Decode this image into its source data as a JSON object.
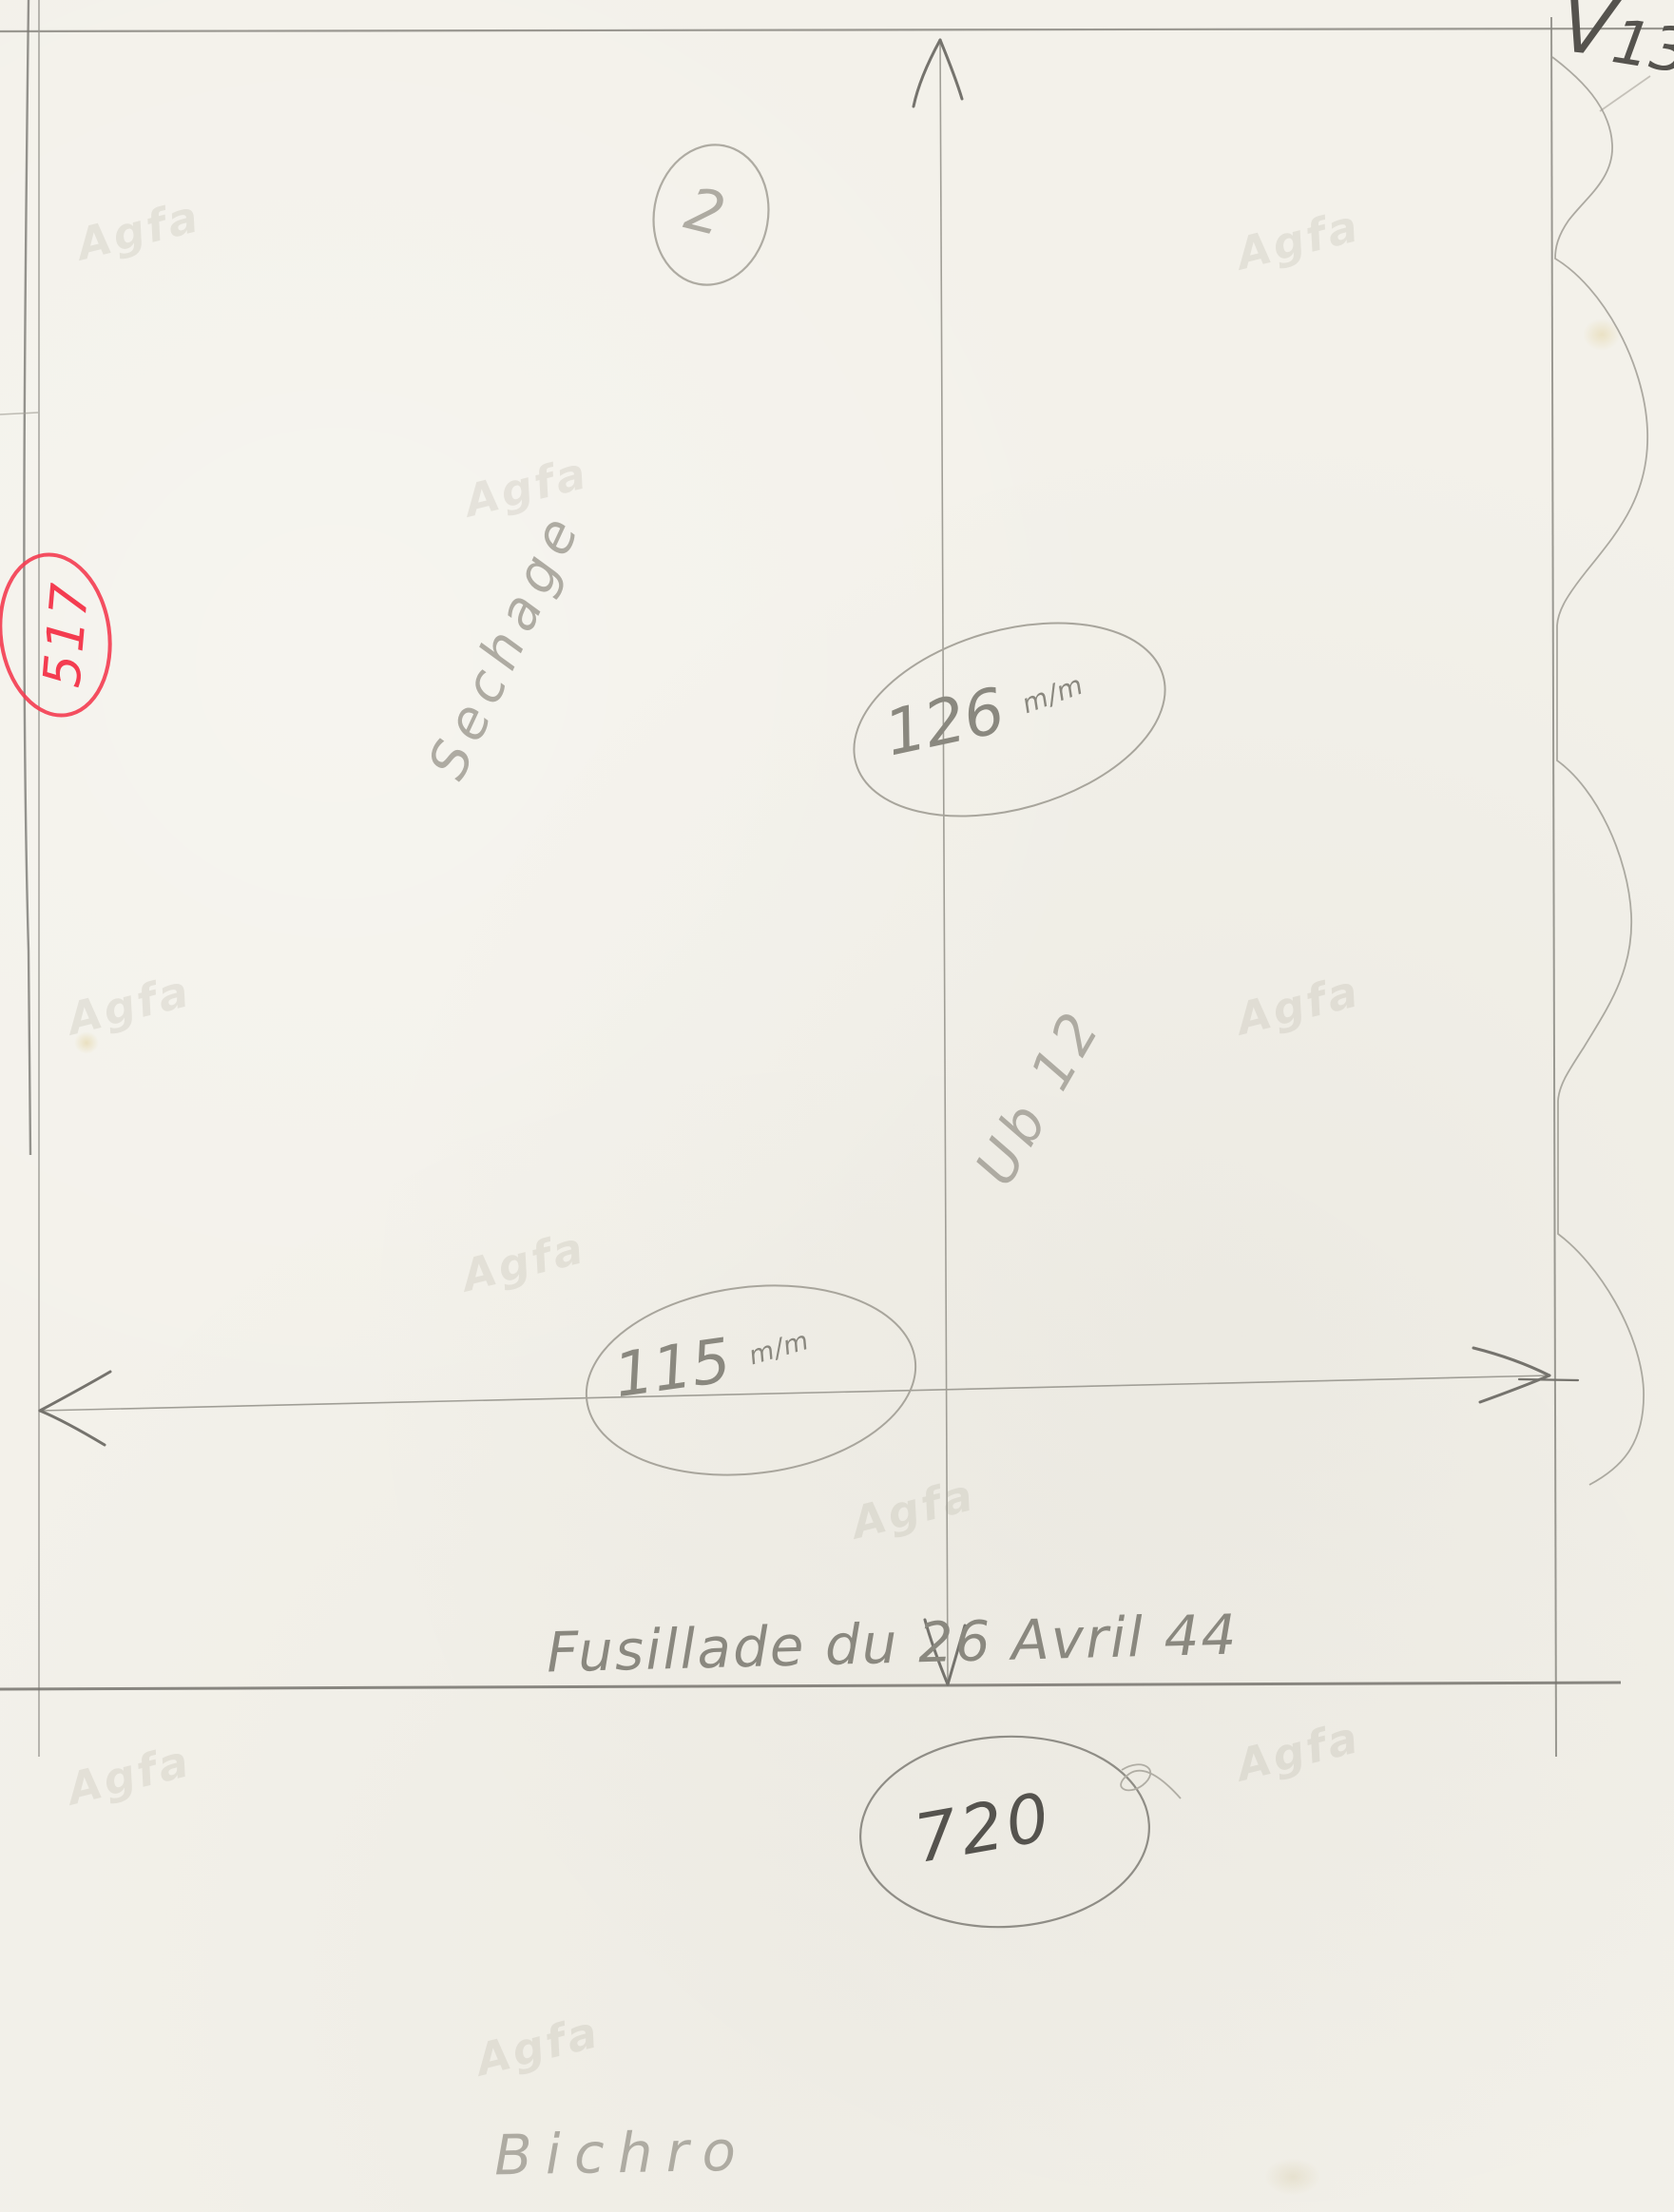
{
  "doc": {
    "page_check_mark": "V",
    "page_number": "13",
    "proof_circle_number": "2",
    "red_index_number": "517",
    "diagonal_note_upper": "Sechage",
    "diagonal_note_lower": "Ub 12",
    "height_dimension": {
      "value": "126",
      "unit": "m/m"
    },
    "width_dimension": {
      "value": "115",
      "unit": "m/m"
    },
    "caption_line": "Fusillade du 26 Avril 44",
    "print_run_number": "720",
    "process_note": "Bichro",
    "paper_watermark": "Agfa"
  },
  "colors": {
    "paper": "#f3f1ea",
    "pencil_dark": "#55534e",
    "pencil": "#8f8d86",
    "pencil_light": "#aeaba2",
    "red_ink": "#f43c50",
    "watermark_tint": "rgba(141,136,115,0.15)"
  }
}
